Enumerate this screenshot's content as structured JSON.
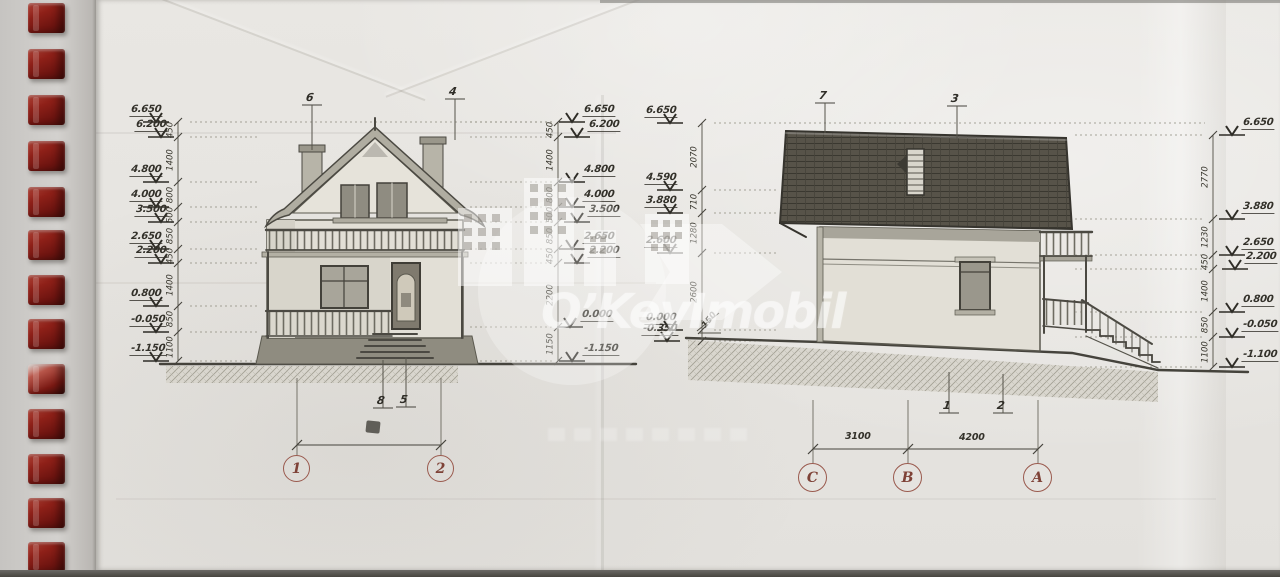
{
  "watermark": {
    "brand_primary": "O’Key",
    "brand_secondary": "Imobil"
  },
  "elevations": {
    "front": {
      "title": "front-elevation",
      "axis_labels": [
        "1",
        "2"
      ],
      "top_callouts": [
        "6",
        "4"
      ],
      "bottom_callouts": [
        "8",
        "5"
      ],
      "left_levels": [
        "6.650",
        "6.200",
        "4.800",
        "4.000",
        "3.500",
        "2.650",
        "2.200",
        "0.800",
        "-0.050",
        "-1.150"
      ],
      "left_chain": [
        "450",
        "1400",
        "800",
        "500",
        "850",
        "450",
        "1400",
        "850",
        "1100"
      ],
      "right_levels": [
        "6.650",
        "6.200",
        "4.800",
        "4.000",
        "3.500",
        "2.650",
        "2.200",
        "0.000",
        "-1.150"
      ],
      "right_chain": [
        "450",
        "1400",
        "800",
        "500",
        "850",
        "450",
        "2200",
        "1150"
      ]
    },
    "side": {
      "title": "side-elevation",
      "axis_labels": [
        "C",
        "B",
        "A"
      ],
      "axis_dimensions": [
        "3100",
        "4200"
      ],
      "top_callouts": [
        "7",
        "3"
      ],
      "bottom_callouts": [
        "1",
        "2"
      ],
      "left_levels": [
        "6.650",
        "4.590",
        "3.880",
        "2.600",
        "0.000",
        "-0.350"
      ],
      "left_chain": [
        "2070",
        "710",
        "1280",
        "2600"
      ],
      "right_levels": [
        "6.650",
        "3.880",
        "2.650",
        "2.200",
        "0.800",
        "-0.050",
        "-1.100"
      ],
      "right_chain": [
        "2770",
        "1230",
        "450",
        "1400",
        "850",
        "1100"
      ],
      "slope_label": "150"
    }
  }
}
